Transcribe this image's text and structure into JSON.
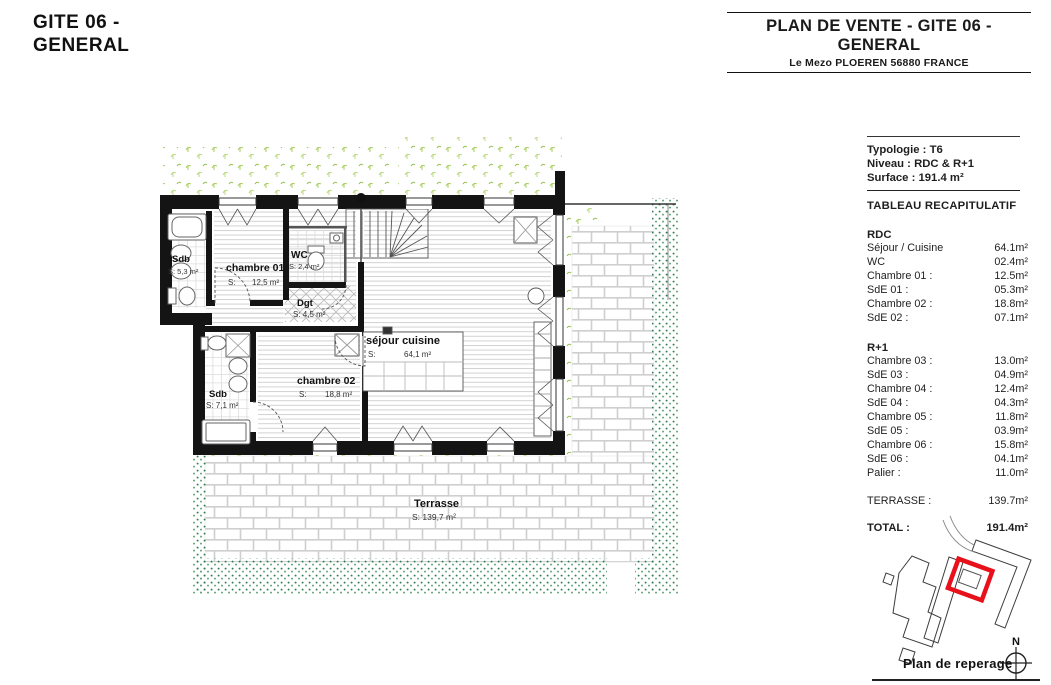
{
  "page": {
    "title_line1": "GITE 06 -",
    "title_line2": "GENERAL"
  },
  "header": {
    "title_line1": "PLAN DE VENTE - GITE 06 -",
    "title_line2": "GENERAL",
    "subtitle": "Le Mezo PLOEREN 56880 FRANCE"
  },
  "summary": {
    "typologie_label": "Typologie :",
    "typologie_value": "T6",
    "niveau_label": "Niveau :",
    "niveau_value": "RDC & R+1",
    "surface_label": "Surface :",
    "surface_value": "191.4 m²",
    "table_title": "TABLEAU RECAPITULATIF",
    "rdc": {
      "title": "RDC",
      "rows": [
        {
          "label": "Séjour / Cuisine",
          "value": "64.1m²"
        },
        {
          "label": "WC",
          "value": "02.4m²"
        },
        {
          "label": "Chambre 01 :",
          "value": "12.5m²"
        },
        {
          "label": "SdE 01 :",
          "value": "05.3m²"
        },
        {
          "label": "Chambre 02 :",
          "value": "18.8m²"
        },
        {
          "label": "SdE 02 :",
          "value": "07.1m²"
        }
      ]
    },
    "r1": {
      "title": "R+1",
      "rows": [
        {
          "label": "Chambre 03 :",
          "value": "13.0m²"
        },
        {
          "label": "SdE 03 :",
          "value": "04.9m²"
        },
        {
          "label": "Chambre 04 :",
          "value": "12.4m²"
        },
        {
          "label": "SdE 04 :",
          "value": "04.3m²"
        },
        {
          "label": "Chambre 05 :",
          "value": "11.8m²"
        },
        {
          "label": "SdE 05 :",
          "value": "03.9m²"
        },
        {
          "label": "Chambre 06 :",
          "value": "15.8m²"
        },
        {
          "label": "SdE 06 :",
          "value": "04.1m²"
        },
        {
          "label": "Palier :",
          "value": "11.0m²"
        }
      ]
    },
    "terrasse": {
      "label": "TERRASSE :",
      "value": "139.7m²"
    },
    "total": {
      "label": "TOTAL :",
      "value": "191.4m²"
    }
  },
  "plan": {
    "sdb1": {
      "name": "Sdb",
      "area": "S: 5,3 m²"
    },
    "chambre01": {
      "name": "chambre 01",
      "s": "S:",
      "area": "12,5 m²"
    },
    "wc": {
      "name": "WC",
      "area": "S: 2,4 m²"
    },
    "dgt": {
      "name": "Dgt",
      "area": "S: 4,5 m²"
    },
    "sdb2": {
      "name": "Sdb",
      "area": "S: 7,1 m²"
    },
    "chambre02": {
      "name": "chambre 02",
      "s": "S:",
      "area": "18,8 m²"
    },
    "sejour": {
      "name": "séjour cuisine",
      "s": "S:",
      "area": "64,1 m²"
    },
    "terrasse": {
      "name": "Terrasse",
      "area": "S: 139,7 m²"
    }
  },
  "reperage": {
    "label": "Plan de reperage",
    "north": "N"
  },
  "colors": {
    "highlight_red": "#e8101a",
    "hedge_green": "#2f7e53",
    "grass_green": "#a8cc60"
  }
}
